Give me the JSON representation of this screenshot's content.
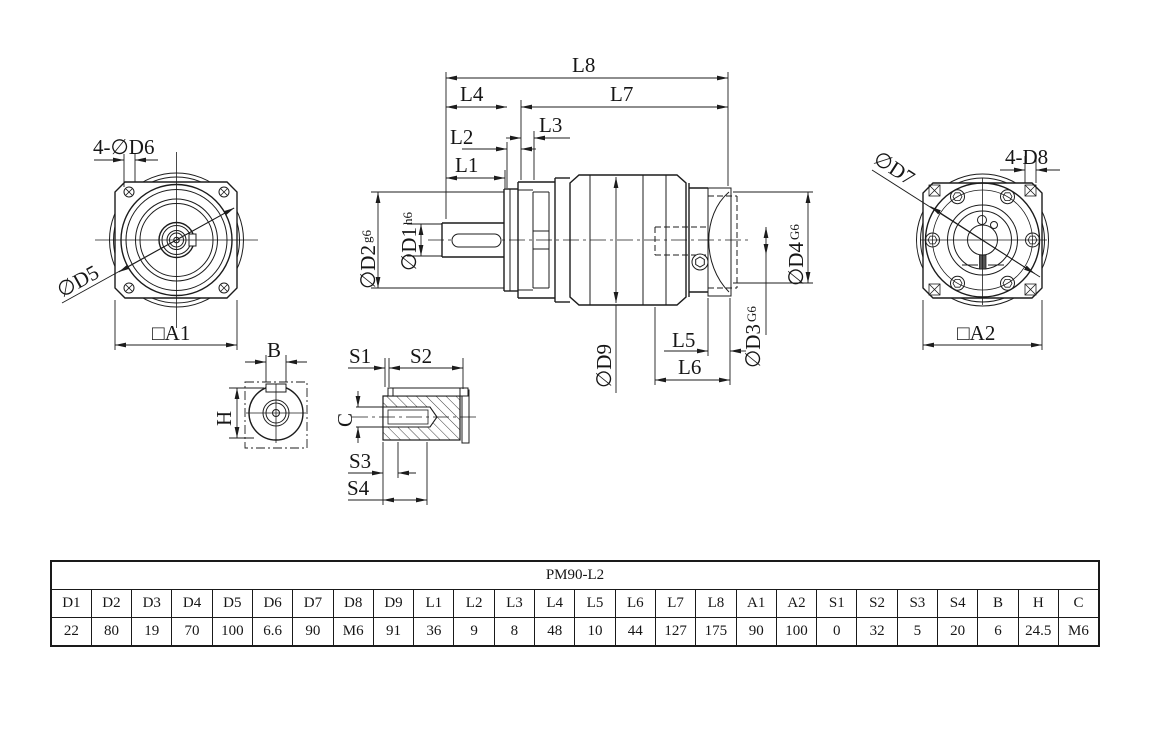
{
  "views": {
    "front": {
      "holes_label": "4-∅D6",
      "circle_label": "∅D5",
      "square_label": "□A1"
    },
    "side": {
      "l1": "L1",
      "l2": "L2",
      "l3": "L3",
      "l4": "L4",
      "l5": "L5",
      "l6": "L6",
      "l7": "L7",
      "l8": "L8",
      "d1": "∅D1",
      "d1_fit": "h6",
      "d2": "∅D2",
      "d2_fit": "g6",
      "d3": "∅D3",
      "d3_fit": "G6",
      "d4": "∅D4",
      "d4_fit": "G6",
      "d9": "∅D9"
    },
    "rear": {
      "circle_label": "∅D7",
      "holes_label": "4-D8",
      "square_label": "□A2"
    },
    "key_section": {
      "width_label": "B",
      "height_label": "H"
    },
    "shaft_detail": {
      "s1": "S1",
      "s2": "S2",
      "s3": "S3",
      "s4": "S4",
      "thread_label": "C"
    }
  },
  "table": {
    "title": "PM90-L2",
    "headers": [
      "D1",
      "D2",
      "D3",
      "D4",
      "D5",
      "D6",
      "D7",
      "D8",
      "D9",
      "L1",
      "L2",
      "L3",
      "L4",
      "L5",
      "L6",
      "L7",
      "L8",
      "A1",
      "A2",
      "S1",
      "S2",
      "S3",
      "S4",
      "B",
      "H",
      "C"
    ],
    "values": [
      "22",
      "80",
      "19",
      "70",
      "100",
      "6.6",
      "90",
      "M6",
      "91",
      "36",
      "9",
      "8",
      "48",
      "10",
      "44",
      "127",
      "175",
      "90",
      "100",
      "0",
      "32",
      "5",
      "20",
      "6",
      "24.5",
      "M6"
    ]
  }
}
